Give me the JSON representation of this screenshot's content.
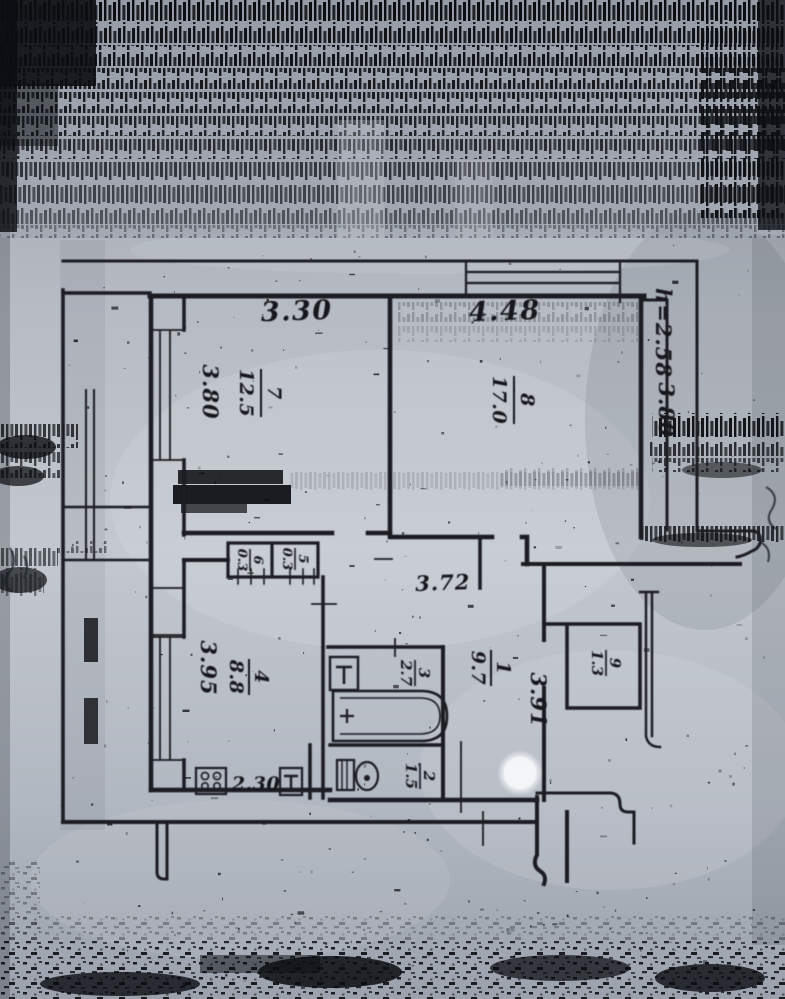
{
  "colors": {
    "ink": "#1a1d23",
    "paper": "#b7bdc6",
    "noise": "#0b0d11",
    "punch_hole": "#f3f5f7"
  },
  "dims": {
    "room7_width": "3.30",
    "room7_depth": "3.80",
    "room8_width": "4.48",
    "room8_depth": "3.80",
    "ceiling_height": "h=2.58",
    "corridor_width": "3.72",
    "hall_depth": "3.91",
    "kitchen_depth": "3.95",
    "kitchen_width": "2.30"
  },
  "rooms": {
    "r1": {
      "num": "1",
      "area": "9.7"
    },
    "r2": {
      "num": "2",
      "area": "1.5"
    },
    "r3": {
      "num": "3",
      "area": "2.7"
    },
    "r4": {
      "num": "4",
      "area": "8.8"
    },
    "r5": {
      "num": "5",
      "area": "0.3"
    },
    "r6": {
      "num": "6",
      "area": "0.3"
    },
    "r7": {
      "num": "7",
      "area": "12.5"
    },
    "r8": {
      "num": "8",
      "area": "17.0"
    },
    "r9": {
      "num": "9",
      "area": "1.3"
    }
  }
}
